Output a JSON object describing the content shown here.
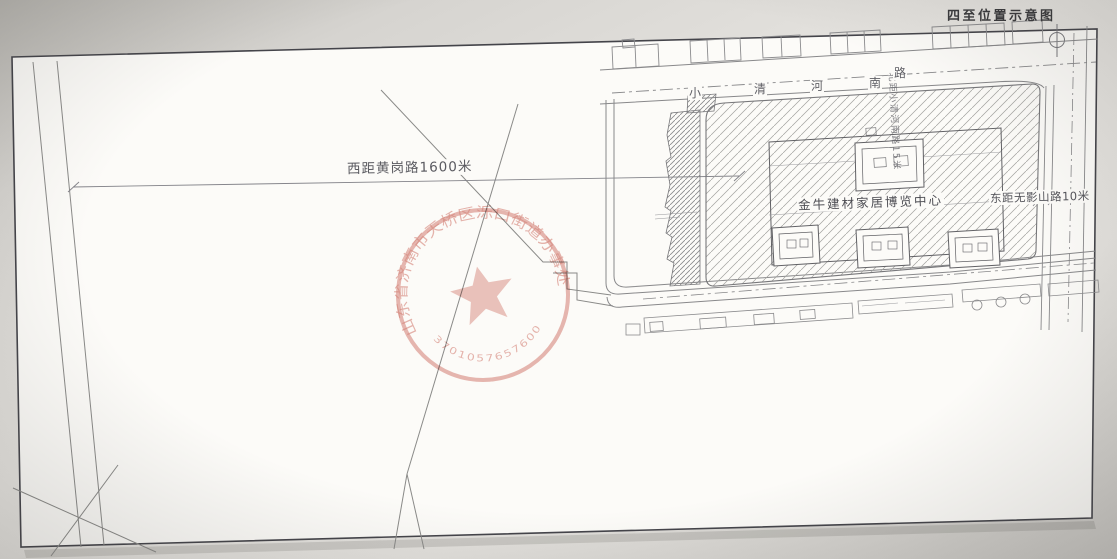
{
  "page": {
    "title": "四至位置示意图"
  },
  "plan": {
    "west_label": "西距黄岗路1600米",
    "north_label": "北距小清河南路15米",
    "east_label": "东距无影山路10米",
    "building_label": "金牛建材家居博览中心",
    "road": {
      "name": "小清河南路",
      "chars": [
        "小",
        "清",
        "河",
        "南",
        "路"
      ]
    }
  },
  "seal": {
    "org_text": "山东省济南市天桥区泺口街道办事处",
    "code": "3701057657600",
    "color": "#c8584c"
  },
  "colors": {
    "paper": "#fcfbf8",
    "line_gray": "#8a8a88",
    "seal_red": "#c8584c"
  }
}
